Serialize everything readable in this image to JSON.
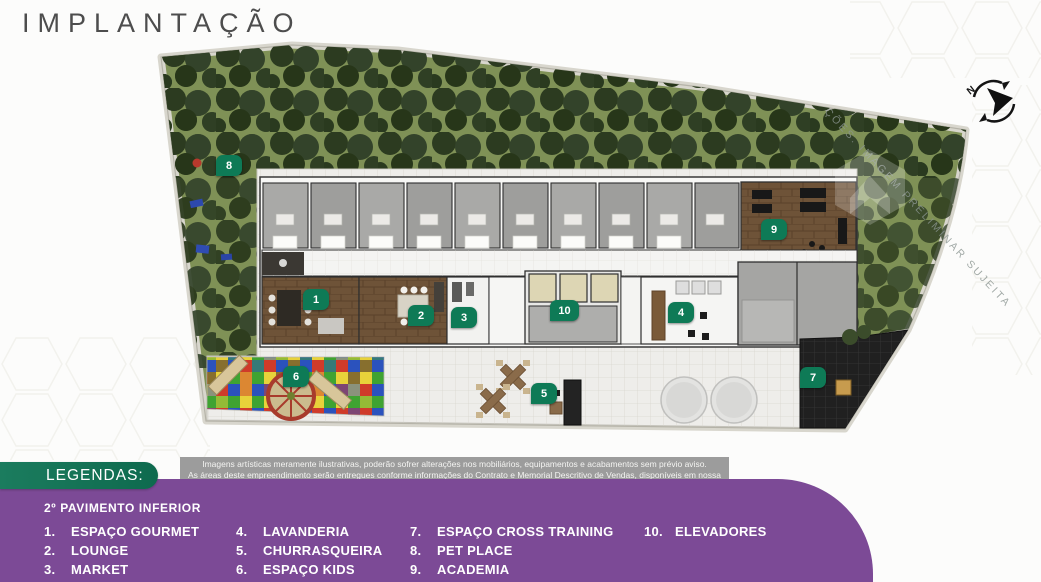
{
  "page": {
    "title": "IMPLANTAÇÃO"
  },
  "plan": {
    "watermark": "ÇÕES. IMAGEM PRELIMINAR SUJEITA",
    "compass_n": "N",
    "markers": [
      {
        "n": "1",
        "label": "ESPAÇO GOURMET",
        "x": 316,
        "y": 300
      },
      {
        "n": "2",
        "label": "LOUNGE",
        "x": 421,
        "y": 316
      },
      {
        "n": "3",
        "label": "MARKET",
        "x": 464,
        "y": 318
      },
      {
        "n": "4",
        "label": "LAVANDERIA",
        "x": 681,
        "y": 313
      },
      {
        "n": "5",
        "label": "CHURRASQUEIRA",
        "x": 544,
        "y": 394
      },
      {
        "n": "6",
        "label": "ESPAÇO KIDS",
        "x": 296,
        "y": 377
      },
      {
        "n": "7",
        "label": "ESPAÇO CROSS TRAINING",
        "x": 813,
        "y": 378
      },
      {
        "n": "8",
        "label": "PET PLACE",
        "x": 229,
        "y": 166
      },
      {
        "n": "9",
        "label": "ACADEMIA",
        "x": 774,
        "y": 230
      },
      {
        "n": "10",
        "label": "ELEVADORES",
        "x": 563,
        "y": 311
      }
    ]
  },
  "disclaimer": {
    "line1": "Imagens artísticas meramente ilustrativas, poderão sofrer alterações nos mobiliários, equipamentos e acabamentos sem prévio aviso.",
    "line2": "As áreas deste empreendimento serão entregues conforme informações do Contrato e Memorial Descritivo de Vendas, disponíveis em nossa loja."
  },
  "legend": {
    "banner": "LEGENDAS:",
    "floor": "2º PAVIMENTO INFERIOR",
    "items": [
      {
        "n": "1.",
        "label": "ESPAÇO GOURMET"
      },
      {
        "n": "2.",
        "label": "LOUNGE"
      },
      {
        "n": "3.",
        "label": "MARKET"
      },
      {
        "n": "4.",
        "label": "LAVANDERIA"
      },
      {
        "n": "5.",
        "label": "CHURRASQUEIRA"
      },
      {
        "n": "6.",
        "label": "ESPAÇO KIDS"
      },
      {
        "n": "7.",
        "label": "ESPAÇO CROSS TRAINING"
      },
      {
        "n": "8.",
        "label": "PET PLACE"
      },
      {
        "n": "9.",
        "label": "ACADEMIA"
      },
      {
        "n": "10.",
        "label": "ELEVADORES"
      }
    ]
  },
  "colors": {
    "purple_band": "#7c4a96",
    "legend_banner_green": "#12745a",
    "marker_green": "#0e7a56",
    "lawn_green": "#7f9156",
    "tree_green": "#2c3b20",
    "disclaimer_gray": "#9c9c9c"
  }
}
